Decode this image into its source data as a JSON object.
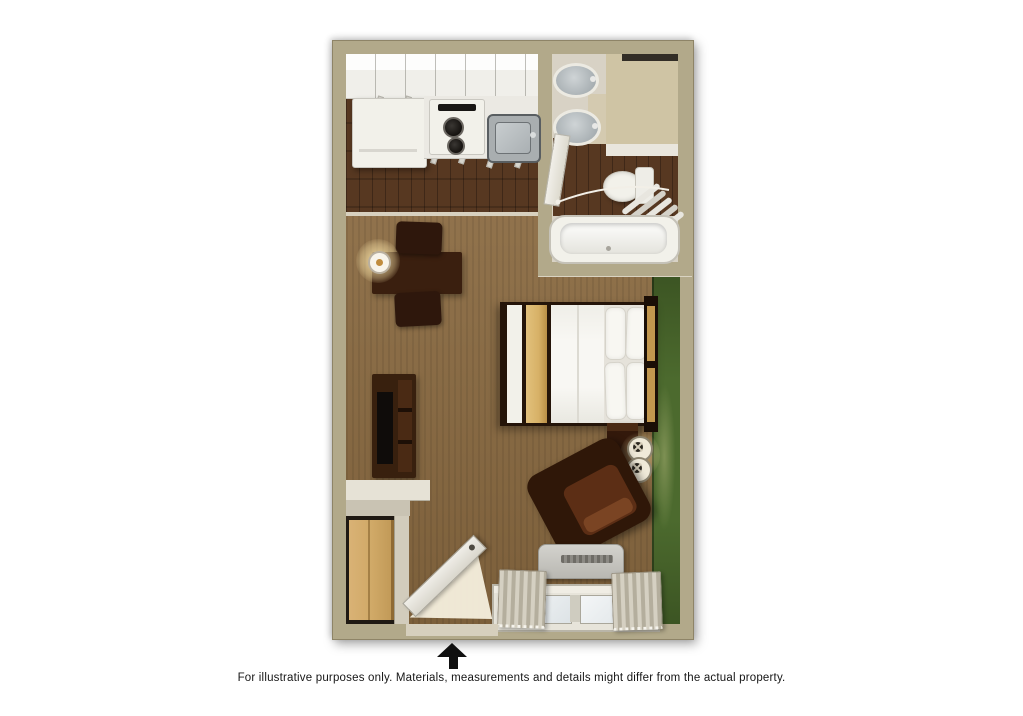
{
  "caption": "For illustrative purposes only.  Materials, measurements and details might differ from the actual property.",
  "floor_plan": {
    "view": "top-down 3D rendering of a studio suite",
    "entrance_direction": "up",
    "rooms": [
      {
        "name": "kitchen",
        "items": [
          "upper-cabinets",
          "refrigerator",
          "two-burner-stove",
          "stainless-sink",
          "counter"
        ]
      },
      {
        "name": "bathroom",
        "items": [
          "vanity-counter",
          "mirror",
          "sink",
          "sink",
          "toilet",
          "towel-rack",
          "bathtub",
          "bathroom-door"
        ]
      },
      {
        "name": "living-sleeping-area",
        "items": [
          "dining-table",
          "chair",
          "chair",
          "wall-lamp",
          "tv-cabinet",
          "tv",
          "bed",
          "gold-bed-runner",
          "pillows",
          "headboard",
          "nightstand",
          "table-lamp",
          "table-lamp",
          "armchair",
          "ac-unit",
          "window",
          "curtains",
          "closet",
          "wardrobe",
          "entry-door"
        ]
      }
    ]
  },
  "colors": {
    "page_bg": "#ffffff",
    "wall": "#b2a98a",
    "wall_edge": "#8e8467",
    "closet_wall": "#e6e2d6",
    "closet_wall_front": "#c9c3b3",
    "carpet": "#8a6a41",
    "carpet_stripe": "#7a5c36",
    "wood": "#573821",
    "wood_plank_line": "#3f2715",
    "wood_light": "#6b4526",
    "accent_green": "#4c6a2e",
    "accent_green_dark": "#3c5523",
    "cabinet_white": "#f0efea",
    "cabinet_bright": "#fdfdfc",
    "fixture_white": "#f2f1ea",
    "fixture_border": "#c5c2b8",
    "steel": "#a9aeb0",
    "steel_dark": "#595e61",
    "furniture": "#3a1f0f",
    "furniture_deep": "#241409",
    "seat_brown": "#5c2e15",
    "bed_gold": "#d7b167",
    "headboard_gold": "#c2974e",
    "pillow_white": "#f8f7f2",
    "wardrobe_wood": "#d0a967",
    "curtain_light": "#d5d0c2",
    "curtain_dark": "#b4ae9d",
    "ac_gray": "#c6c5bf",
    "glow": "#ffe9ac",
    "arrow": "#101010",
    "caption": "#161616",
    "door_white": "#e9e6de",
    "floor_spill": "#f6efdd",
    "bath_base": "#d8d2c5",
    "vanity_beige": "#cfc4a4",
    "mirror_dark": "#322d26"
  }
}
